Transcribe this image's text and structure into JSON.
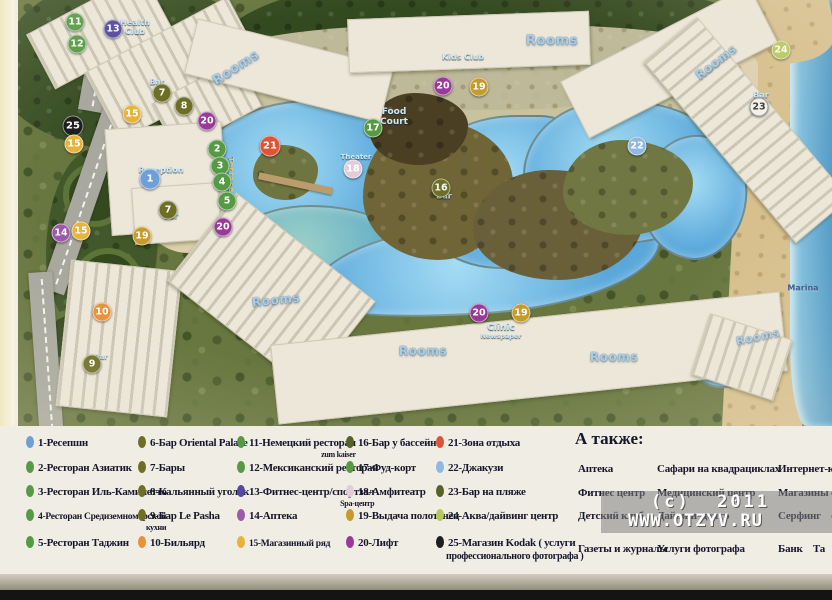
{
  "watermark": {
    "line1": "(c)  2011",
    "line2": "WWW.OTZYV.RU"
  },
  "colors": {
    "blue": "#6f9fd8",
    "green": "#569a45",
    "olive": "#6e6e26",
    "orange": "#e8913a",
    "indigo": "#5548a0",
    "violet": "#9a5aa8",
    "gold": "#e6b33d",
    "dgold": "#c79b2a",
    "pink": "#e3cbd8",
    "purple": "#993a99",
    "red": "#dd5537",
    "lblue": "#8fb9e4",
    "dolive": "#566226",
    "ygreen": "#b5c85c",
    "black": "#1e1e1e",
    "white": "#f2f2ea"
  },
  "map": {
    "markers": [
      {
        "n": "11",
        "c": "green",
        "x": 71,
        "y": 22
      },
      {
        "n": "13",
        "c": "indigo",
        "x": 109,
        "y": 29
      },
      {
        "n": "12",
        "c": "green",
        "x": 73,
        "y": 44
      },
      {
        "n": "24",
        "c": "ygreen",
        "x": 777,
        "y": 50
      },
      {
        "n": "7",
        "c": "olive",
        "x": 158,
        "y": 93
      },
      {
        "n": "20",
        "c": "purple",
        "x": 439,
        "y": 86
      },
      {
        "n": "19",
        "c": "dgold",
        "x": 475,
        "y": 87
      },
      {
        "n": "8",
        "c": "olive",
        "x": 180,
        "y": 106
      },
      {
        "n": "23",
        "c": "white",
        "x": 755,
        "y": 107
      },
      {
        "n": "15",
        "c": "gold",
        "x": 128,
        "y": 114
      },
      {
        "n": "20",
        "c": "purple",
        "x": 203,
        "y": 121
      },
      {
        "n": "25",
        "c": "black",
        "x": 69,
        "y": 126,
        "big": true
      },
      {
        "n": "17",
        "c": "green",
        "x": 369,
        "y": 128
      },
      {
        "n": "21",
        "c": "red",
        "x": 266,
        "y": 146,
        "big": true
      },
      {
        "n": "22",
        "c": "lblue",
        "x": 633,
        "y": 146
      },
      {
        "n": "15",
        "c": "gold",
        "x": 70,
        "y": 144
      },
      {
        "n": "2",
        "c": "green",
        "x": 213,
        "y": 149
      },
      {
        "n": "3",
        "c": "green",
        "x": 216,
        "y": 166
      },
      {
        "n": "18",
        "c": "pink",
        "x": 349,
        "y": 169
      },
      {
        "n": "1",
        "c": "blue",
        "x": 146,
        "y": 179,
        "big": true
      },
      {
        "n": "4",
        "c": "green",
        "x": 218,
        "y": 182
      },
      {
        "n": "16",
        "c": "olive",
        "x": 437,
        "y": 188
      },
      {
        "n": "5",
        "c": "green",
        "x": 223,
        "y": 201
      },
      {
        "n": "7",
        "c": "olive",
        "x": 164,
        "y": 210
      },
      {
        "n": "20",
        "c": "purple",
        "x": 219,
        "y": 227
      },
      {
        "n": "14",
        "c": "violet",
        "x": 57,
        "y": 233
      },
      {
        "n": "15",
        "c": "gold",
        "x": 77,
        "y": 231
      },
      {
        "n": "19",
        "c": "dgold",
        "x": 138,
        "y": 236
      },
      {
        "n": "10",
        "c": "orange",
        "x": 98,
        "y": 312
      },
      {
        "n": "20",
        "c": "purple",
        "x": 475,
        "y": 313
      },
      {
        "n": "19",
        "c": "dgold",
        "x": 517,
        "y": 313
      },
      {
        "n": "9",
        "c": "olive",
        "x": 88,
        "y": 364
      }
    ],
    "labels": [
      {
        "t": "Rooms",
        "k": "rooms",
        "x": 232,
        "y": 68,
        "r": -33,
        "s": 13
      },
      {
        "t": "Rooms",
        "k": "rooms",
        "x": 548,
        "y": 41,
        "r": 0,
        "s": 13
      },
      {
        "t": "Rooms",
        "k": "rooms",
        "x": 712,
        "y": 62,
        "r": -38,
        "s": 12
      },
      {
        "t": "Rooms",
        "k": "rooms",
        "x": 272,
        "y": 300,
        "r": -6,
        "s": 12
      },
      {
        "t": "Rooms",
        "k": "rooms",
        "x": 419,
        "y": 351,
        "r": 0,
        "s": 12
      },
      {
        "t": "Rooms",
        "k": "rooms",
        "x": 610,
        "y": 357,
        "r": 0,
        "s": 12
      },
      {
        "t": "Rooms",
        "k": "rooms",
        "x": 754,
        "y": 337,
        "r": -12,
        "s": 11
      },
      {
        "t": "Health\nClub",
        "k": "small",
        "x": 131,
        "y": 27,
        "r": 0,
        "s": 8
      },
      {
        "t": "Kids Club",
        "k": "small",
        "x": 459,
        "y": 57,
        "r": 0,
        "s": 8
      },
      {
        "t": "Food\nCourt",
        "k": "small",
        "x": 390,
        "y": 117,
        "r": 0,
        "s": 9
      },
      {
        "t": "Theater",
        "k": "small",
        "x": 352,
        "y": 157,
        "r": 0,
        "s": 7
      },
      {
        "t": "Reception",
        "k": "small",
        "x": 157,
        "y": 170,
        "r": 0,
        "s": 8
      },
      {
        "t": "Clinic",
        "k": "small",
        "x": 497,
        "y": 328,
        "r": 0,
        "s": 9
      },
      {
        "t": "Newspaper",
        "k": "small",
        "x": 497,
        "y": 336,
        "r": 0,
        "s": 6.5
      },
      {
        "t": "Marina",
        "k": "marina",
        "x": 799,
        "y": 288,
        "r": 0,
        "s": 8
      },
      {
        "t": "Bar",
        "k": "small",
        "x": 153,
        "y": 82,
        "r": 0,
        "s": 7.5
      },
      {
        "t": "Bar",
        "k": "small",
        "x": 167,
        "y": 216,
        "r": 0,
        "s": 7.5
      },
      {
        "t": "Bar",
        "k": "small",
        "x": 440,
        "y": 196,
        "r": 0,
        "s": 8
      },
      {
        "t": "Bar",
        "k": "small",
        "x": 757,
        "y": 95,
        "r": 0,
        "s": 8
      },
      {
        "t": "Bar",
        "k": "small",
        "x": 97,
        "y": 357,
        "r": 0,
        "s": 7
      },
      {
        "t": "Terrace",
        "k": "terrace",
        "x": 227,
        "y": 175,
        "r": 90,
        "s": 7
      }
    ]
  },
  "legend": {
    "columns": [
      [
        {
          "c": "blue",
          "label": "1-Ресепшн"
        },
        {
          "c": "green",
          "label": "2-Ресторан Азиатик"
        },
        {
          "c": "green",
          "label": "3-Ресторан Иль-Каминетто"
        },
        {
          "c": "green",
          "label": "4-Ресторан Средиземноморской",
          "sub": "кухни",
          "small": true
        },
        {
          "c": "green",
          "label": "5-Ресторан Таджин"
        }
      ],
      [
        {
          "c": "olive",
          "label": "6-Бар Oriental Palace"
        },
        {
          "c": "olive",
          "label": "7-Бары"
        },
        {
          "c": "olive",
          "label": "8-Кальянный уголок"
        },
        {
          "c": "olive",
          "label": "9-Бар Le Pasha"
        },
        {
          "c": "orange",
          "label": "10-Бильярд"
        }
      ],
      [
        {
          "c": "green",
          "label": "11-Немецкий ресторан",
          "sub": "zum kaiser"
        },
        {
          "c": "green",
          "label": "12-Мексиканский ресторан"
        },
        {
          "c": "indigo",
          "label": "13-Фитнес-центр/спортзал",
          "sub": "Spa-центр"
        },
        {
          "c": "violet",
          "label": "14-Аптека"
        },
        {
          "c": "gold",
          "label": "15-Магазинный ряд",
          "small": true
        }
      ],
      [
        {
          "c": "dolive",
          "label": "16-Бар у бассейна"
        },
        {
          "c": "green",
          "label": "17-Фуд-корт"
        },
        {
          "c": "pink",
          "label": "18-Амфитеатр"
        },
        {
          "c": "dgold",
          "label": "19-Выдача полотенец"
        },
        {
          "c": "purple",
          "label": "20-Лифт"
        }
      ],
      [
        {
          "c": "red",
          "label": "21-Зона отдыха"
        },
        {
          "c": "lblue",
          "label": "22-Джакузи"
        },
        {
          "c": "dolive",
          "label": "23-Бар на пляже"
        },
        {
          "c": "ygreen",
          "label": "24-Аква/дайвинг центр"
        },
        {
          "c": "black",
          "label": "25-Магазин Kodak ( услуги",
          "sub2": "профессионального фотографа )"
        }
      ]
    ],
    "also": {
      "heading": "А также:",
      "col1": [
        "Аптека",
        "Фитнес центр",
        "Детский клуб",
        "Газеты и журналы"
      ],
      "col2": [
        "Сафари на квадрациклах",
        "Медицинский центр",
        "Дайвинг центр",
        "Услуги фотографа"
      ],
      "col3": [
        "Интернет-кафе",
        "Магазины суве",
        "Серфинг    сн",
        "Банк    Та"
      ]
    }
  }
}
